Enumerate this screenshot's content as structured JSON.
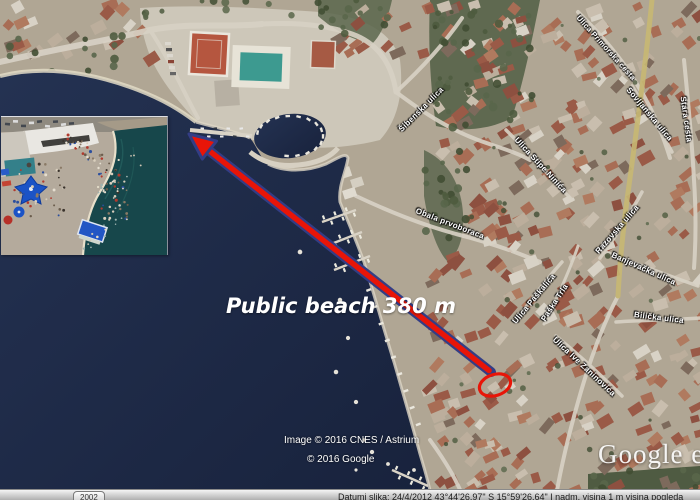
{
  "map": {
    "distance_label": "Public beach 380 m",
    "street_labels": [
      {
        "text": "Šibenska ulica"
      },
      {
        "text": "Ulica Primorska cesta"
      },
      {
        "text": "Sovljanska ulica"
      },
      {
        "text": "Stara cesta"
      },
      {
        "text": "Ulica Stipe Ninića"
      },
      {
        "text": "Obala prvoboraca"
      },
      {
        "text": "Razovska ulica"
      },
      {
        "text": "Banjevačka ulica"
      },
      {
        "text": "Bilička ulica"
      },
      {
        "text": "Ulica Paškalića"
      },
      {
        "text": "Ulica Ive Zaninovića"
      },
      {
        "text": "Paška Trla"
      }
    ]
  },
  "attribution": {
    "imagery_credit": "Image © 2016 CNES / Astrium",
    "copyright": "© 2016 Google",
    "watermark": "Google e"
  },
  "status_bar": {
    "year_chip": "2002",
    "info": "Datumi slika: 24/4/2012      43°44'26.97\" S    15°59'26.64\" I    nadm. visina   1 m    visina pogleda"
  },
  "colors": {
    "sea": "#1d2a47",
    "arrow_red": "#e81508",
    "arrow_outline": "#333d85",
    "circle_red": "#e81508"
  }
}
